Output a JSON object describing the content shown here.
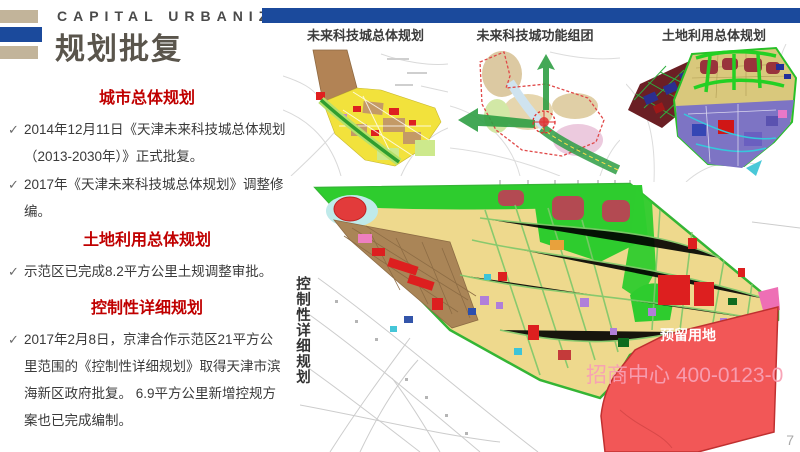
{
  "header": {
    "kicker": "CAPITAL URBANIZATION",
    "title": "规划批复"
  },
  "glyphs": {
    "check": "✓"
  },
  "sections": [
    {
      "heading": "城市总体规划",
      "bullets": [
        "2014年12月11日《天津未来科技城总体规划（2013-2030年）》正式批复。",
        "2017年《天津未来科技城总体规划》调整修编。"
      ]
    },
    {
      "heading": "土地利用总体规划",
      "bullets": [
        "示范区已完成8.2平方公里土规调整审批。"
      ]
    },
    {
      "heading": "控制性详细规划",
      "bullets": [
        "2017年2月8日，京津合作示范区21平方公里范围的《控制性详细规划》取得天津市滨海新区政府批复。 6.9平方公里新增控规方案也已完成编制。"
      ]
    }
  ],
  "maps": {
    "small": [
      {
        "title": "未来科技城总体规划"
      },
      {
        "title": "未来科技城功能组团"
      },
      {
        "title": "土地利用总体规划"
      }
    ],
    "large": {
      "side_label": "控制性详细规划",
      "reserved_label": "预留用地",
      "watermark": "招商中心 400-0123-0"
    }
  },
  "page": {
    "number": "7"
  },
  "colors": {
    "heading_red": "#c00000",
    "accent_blue": "#1b4a9c",
    "accent_tan": "#c2b49a",
    "reserved_red": "#f25757"
  }
}
